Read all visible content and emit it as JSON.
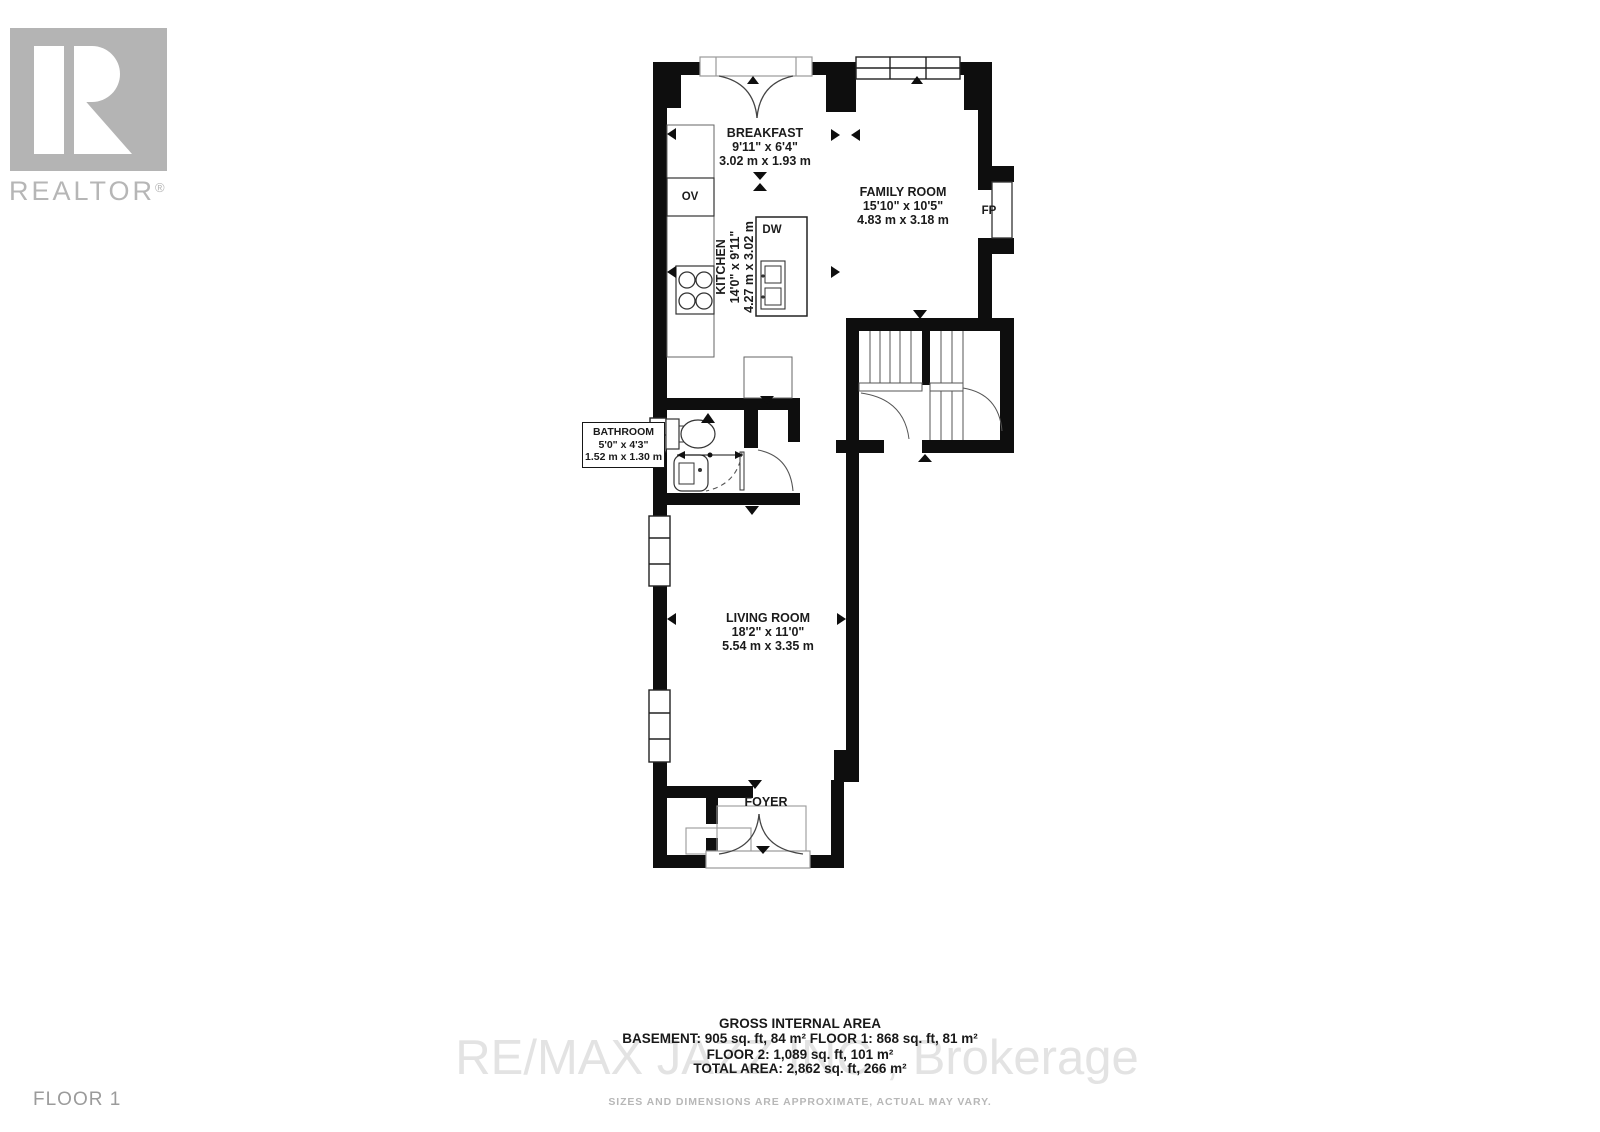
{
  "branding": {
    "realtor_logo_text": "REALTOR",
    "registered_mark": "®"
  },
  "watermark": {
    "brokerage": "RE/MAX JAZZ INC., Brokerage"
  },
  "floor_label": "FLOOR 1",
  "rooms": {
    "breakfast": {
      "name": "BREAKFAST",
      "imperial": "9'11\" x 6'4\"",
      "metric": "3.02 m x 1.93 m"
    },
    "family_room": {
      "name": "FAMILY ROOM",
      "imperial": "15'10\" x 10'5\"",
      "metric": "4.83 m x 3.18 m"
    },
    "kitchen": {
      "name": "KITCHEN",
      "imperial": "14'0\" x 9'11\"",
      "metric": "4.27 m x 3.02 m"
    },
    "bathroom": {
      "name": "BATHROOM",
      "imperial": "5'0\" x 4'3\"",
      "metric": "1.52 m x 1.30 m"
    },
    "living_room": {
      "name": "LIVING ROOM",
      "imperial": "18'2\" x 11'0\"",
      "metric": "5.54 m x 3.35 m"
    },
    "foyer": {
      "name": "FOYER"
    }
  },
  "fixtures": {
    "oven": "OV",
    "dishwasher": "DW",
    "fireplace": "FP"
  },
  "footer": {
    "title": "GROSS INTERNAL AREA",
    "line1": "BASEMENT: 905 sq. ft, 84 m² FLOOR 1: 868 sq. ft, 81 m²",
    "line2": "FLOOR 2: 1,089 sq. ft, 101 m²",
    "line3": "TOTAL AREA: 2,862 sq. ft, 266 m²",
    "disclaimer": "SIZES AND DIMENSIONS ARE APPROXIMATE, ACTUAL MAY VARY."
  },
  "colors": {
    "wall": "#0e0e0e",
    "fixture_line": "#444444",
    "logo_gray": "#b4b4b4",
    "watermark_gray": "#e3e3e3",
    "muted_gray": "#9b9b9b",
    "label_text": "#1b1b1b"
  }
}
